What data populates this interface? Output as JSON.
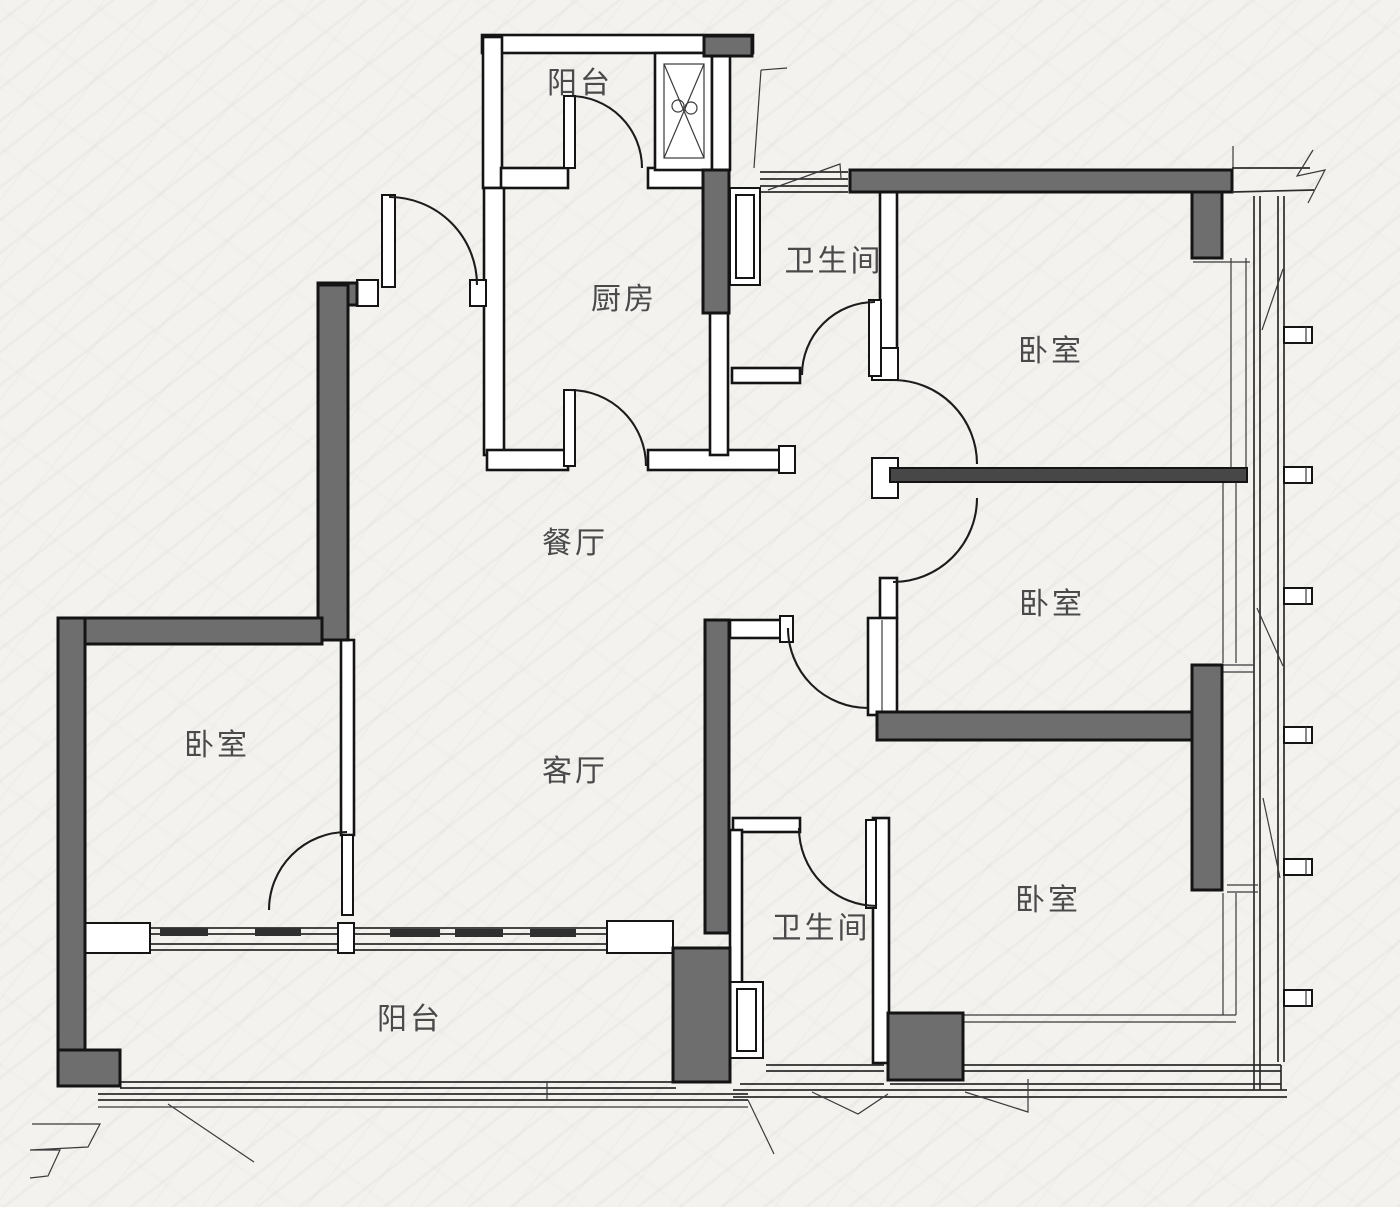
{
  "drawing": {
    "type": "apartment-floor-plan",
    "style": "architectural line drawing, plan view"
  },
  "rooms": [
    {
      "id": "balcony-top",
      "label": "阳台"
    },
    {
      "id": "kitchen",
      "label": "厨房"
    },
    {
      "id": "bathroom-top",
      "label": "卫生间"
    },
    {
      "id": "bedroom-top-right",
      "label": "卧室"
    },
    {
      "id": "dining-room",
      "label": "餐厅"
    },
    {
      "id": "bedroom-mid-right",
      "label": "卧室"
    },
    {
      "id": "bedroom-left",
      "label": "卧室"
    },
    {
      "id": "living-room",
      "label": "客厅"
    },
    {
      "id": "bathroom-bottom",
      "label": "卫生间"
    },
    {
      "id": "bedroom-bottom-right",
      "label": "卧室"
    },
    {
      "id": "balcony-bottom",
      "label": "阳台"
    }
  ],
  "colors": {
    "background": "#f3f2ef",
    "structural_wall_fill": "#6e6e6e",
    "partition_bar_fill": "#474747",
    "wall_outline": "#141414",
    "label_text": "#4a4a4a"
  },
  "symbols": [
    {
      "id": "flue-shaft",
      "description": "duct shaft crossed with X beside top balcony"
    },
    {
      "id": "wall-break",
      "description": "zigzag wall continuation mark, top right and bottom left"
    },
    {
      "id": "window-brackets",
      "description": "notched mullion brackets along right window band"
    }
  ]
}
